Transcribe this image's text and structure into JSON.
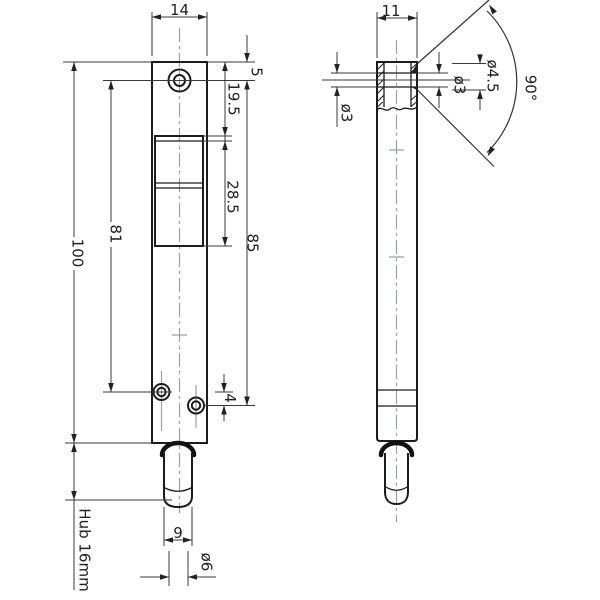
{
  "colors": {
    "background": "#ffffff",
    "object_line": "#1c1c1c",
    "dimension_line": "#3a3a3a",
    "centerline": "#9aa0a8",
    "text": "#222222"
  },
  "front_view": {
    "dims": {
      "width": "14",
      "top_hole_offset": "5",
      "cutout_top_offset": "19.5",
      "cutout_height": "28.5",
      "hole_span_inner": "81",
      "hole_span_outer": "85",
      "total_height": "100",
      "bottom_holes_gap": "4",
      "pin_head_width": "9",
      "pin_tip_diameter": "ø6",
      "stroke_label": "Hub 16mm"
    }
  },
  "side_view": {
    "dims": {
      "width": "11",
      "side_bore": "ø3",
      "front_bore": "ø3",
      "countersink_diameter": "ø4.5",
      "countersink_angle": "90°"
    }
  }
}
